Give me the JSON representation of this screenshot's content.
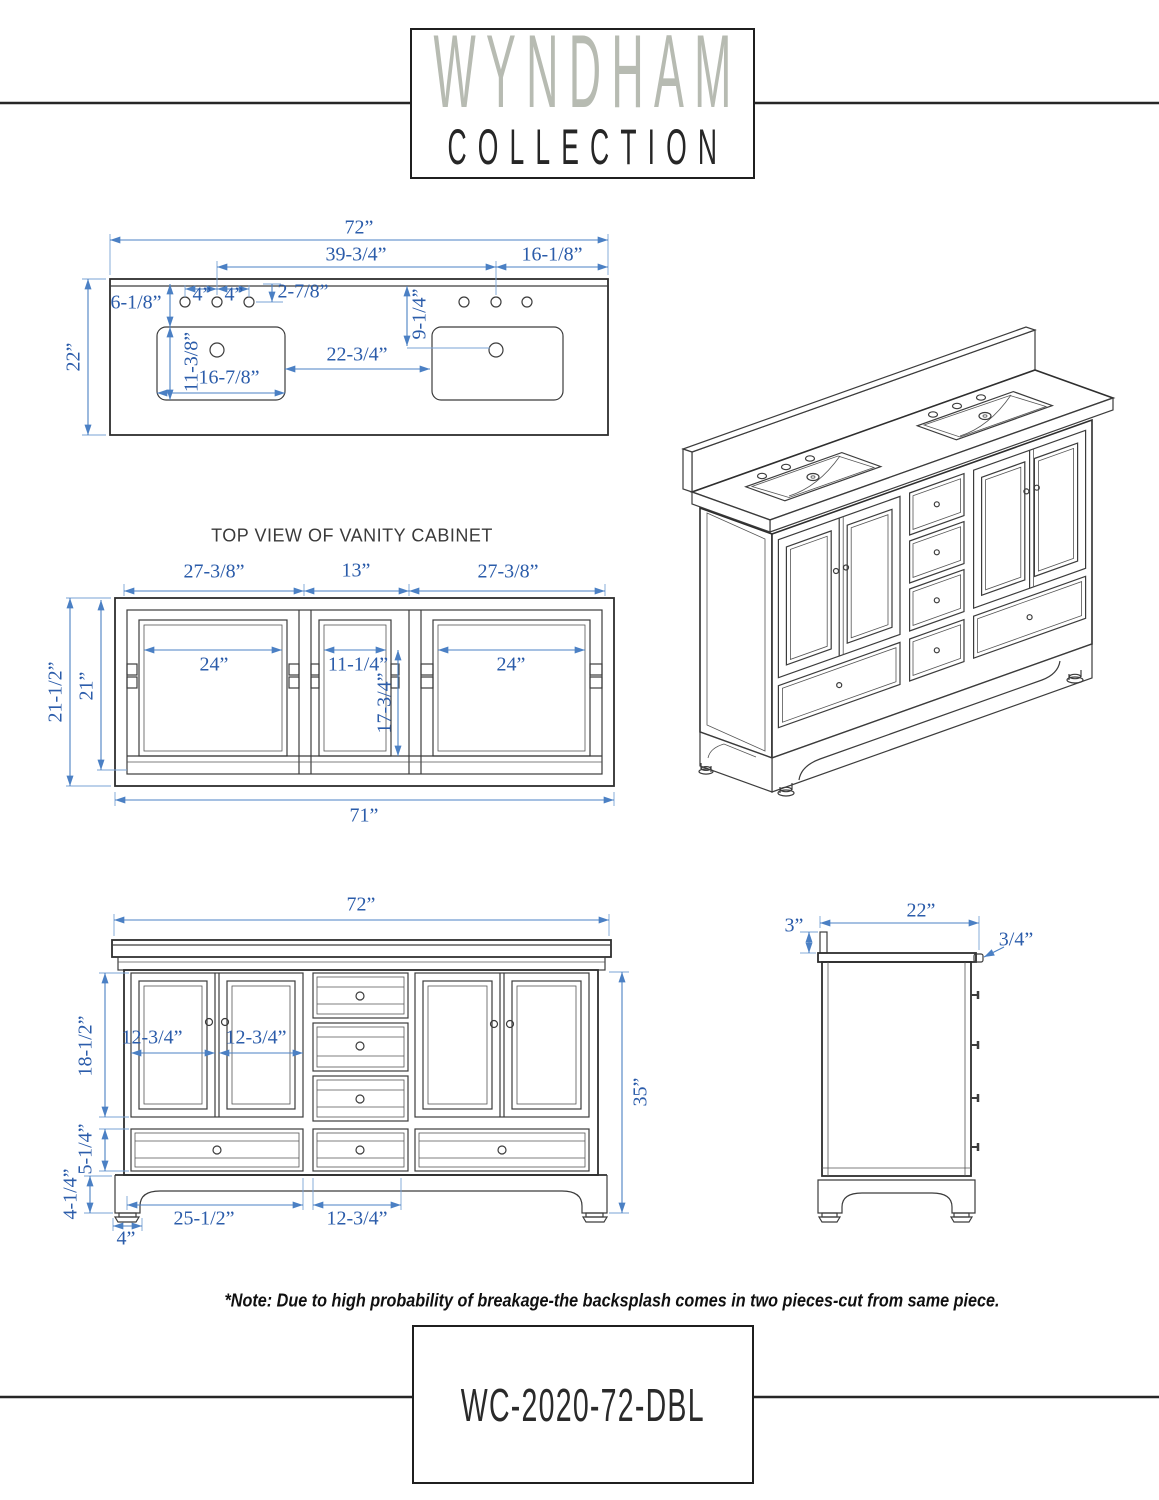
{
  "logo": {
    "top": "WYNDHAM",
    "bottom": "COLLECTION"
  },
  "countertop_view": {
    "dims": {
      "width": "72”",
      "center_to_center": "39-3/4”",
      "right_offset": "16-1/8”",
      "edge_to_sink": "6-1/8”",
      "hole_spacing": "4”",
      "top_to_hole": "2-7/8”",
      "depth": "22”",
      "sink_depth": "11-3/8”",
      "sink_width": "16-7/8”",
      "between_sinks": "22-3/4”",
      "to_drain": "9-1/4”"
    }
  },
  "cabinet_top_view": {
    "title": "TOP VIEW OF VANITY CABINET",
    "dims": {
      "sec_outer": "27-3/8”",
      "sec_mid": "13”",
      "door_opening": "24”",
      "mid_opening": "11-1/4”",
      "mid_depth": "17-3/4”",
      "depth_outer": "21-1/2”",
      "depth_inner": "21”",
      "width": "71”"
    }
  },
  "front_view": {
    "dims": {
      "width": "72”",
      "door": "12-3/4”",
      "door_height": "18-1/2”",
      "drawer_height": "5-1/4”",
      "base_height": "4-1/4”",
      "foot": "4”",
      "bottom_drawer": "25-1/2”",
      "mid_drawer": "12-3/4”",
      "height": "35”"
    }
  },
  "side_view": {
    "dims": {
      "backsplash_height": "3”",
      "depth": "22”",
      "counter_thickness": "3/4”"
    }
  },
  "note": "*Note: Due to high probability of breakage-the backsplash comes in two pieces-cut from same piece.",
  "model": "WC-2020-72-DBL",
  "colors": {
    "dim_text": "#2b5caa",
    "dim_line": "#4b80c4",
    "drawing_line": "#3c3c3c",
    "logo_gray": "#b7bbb2"
  }
}
